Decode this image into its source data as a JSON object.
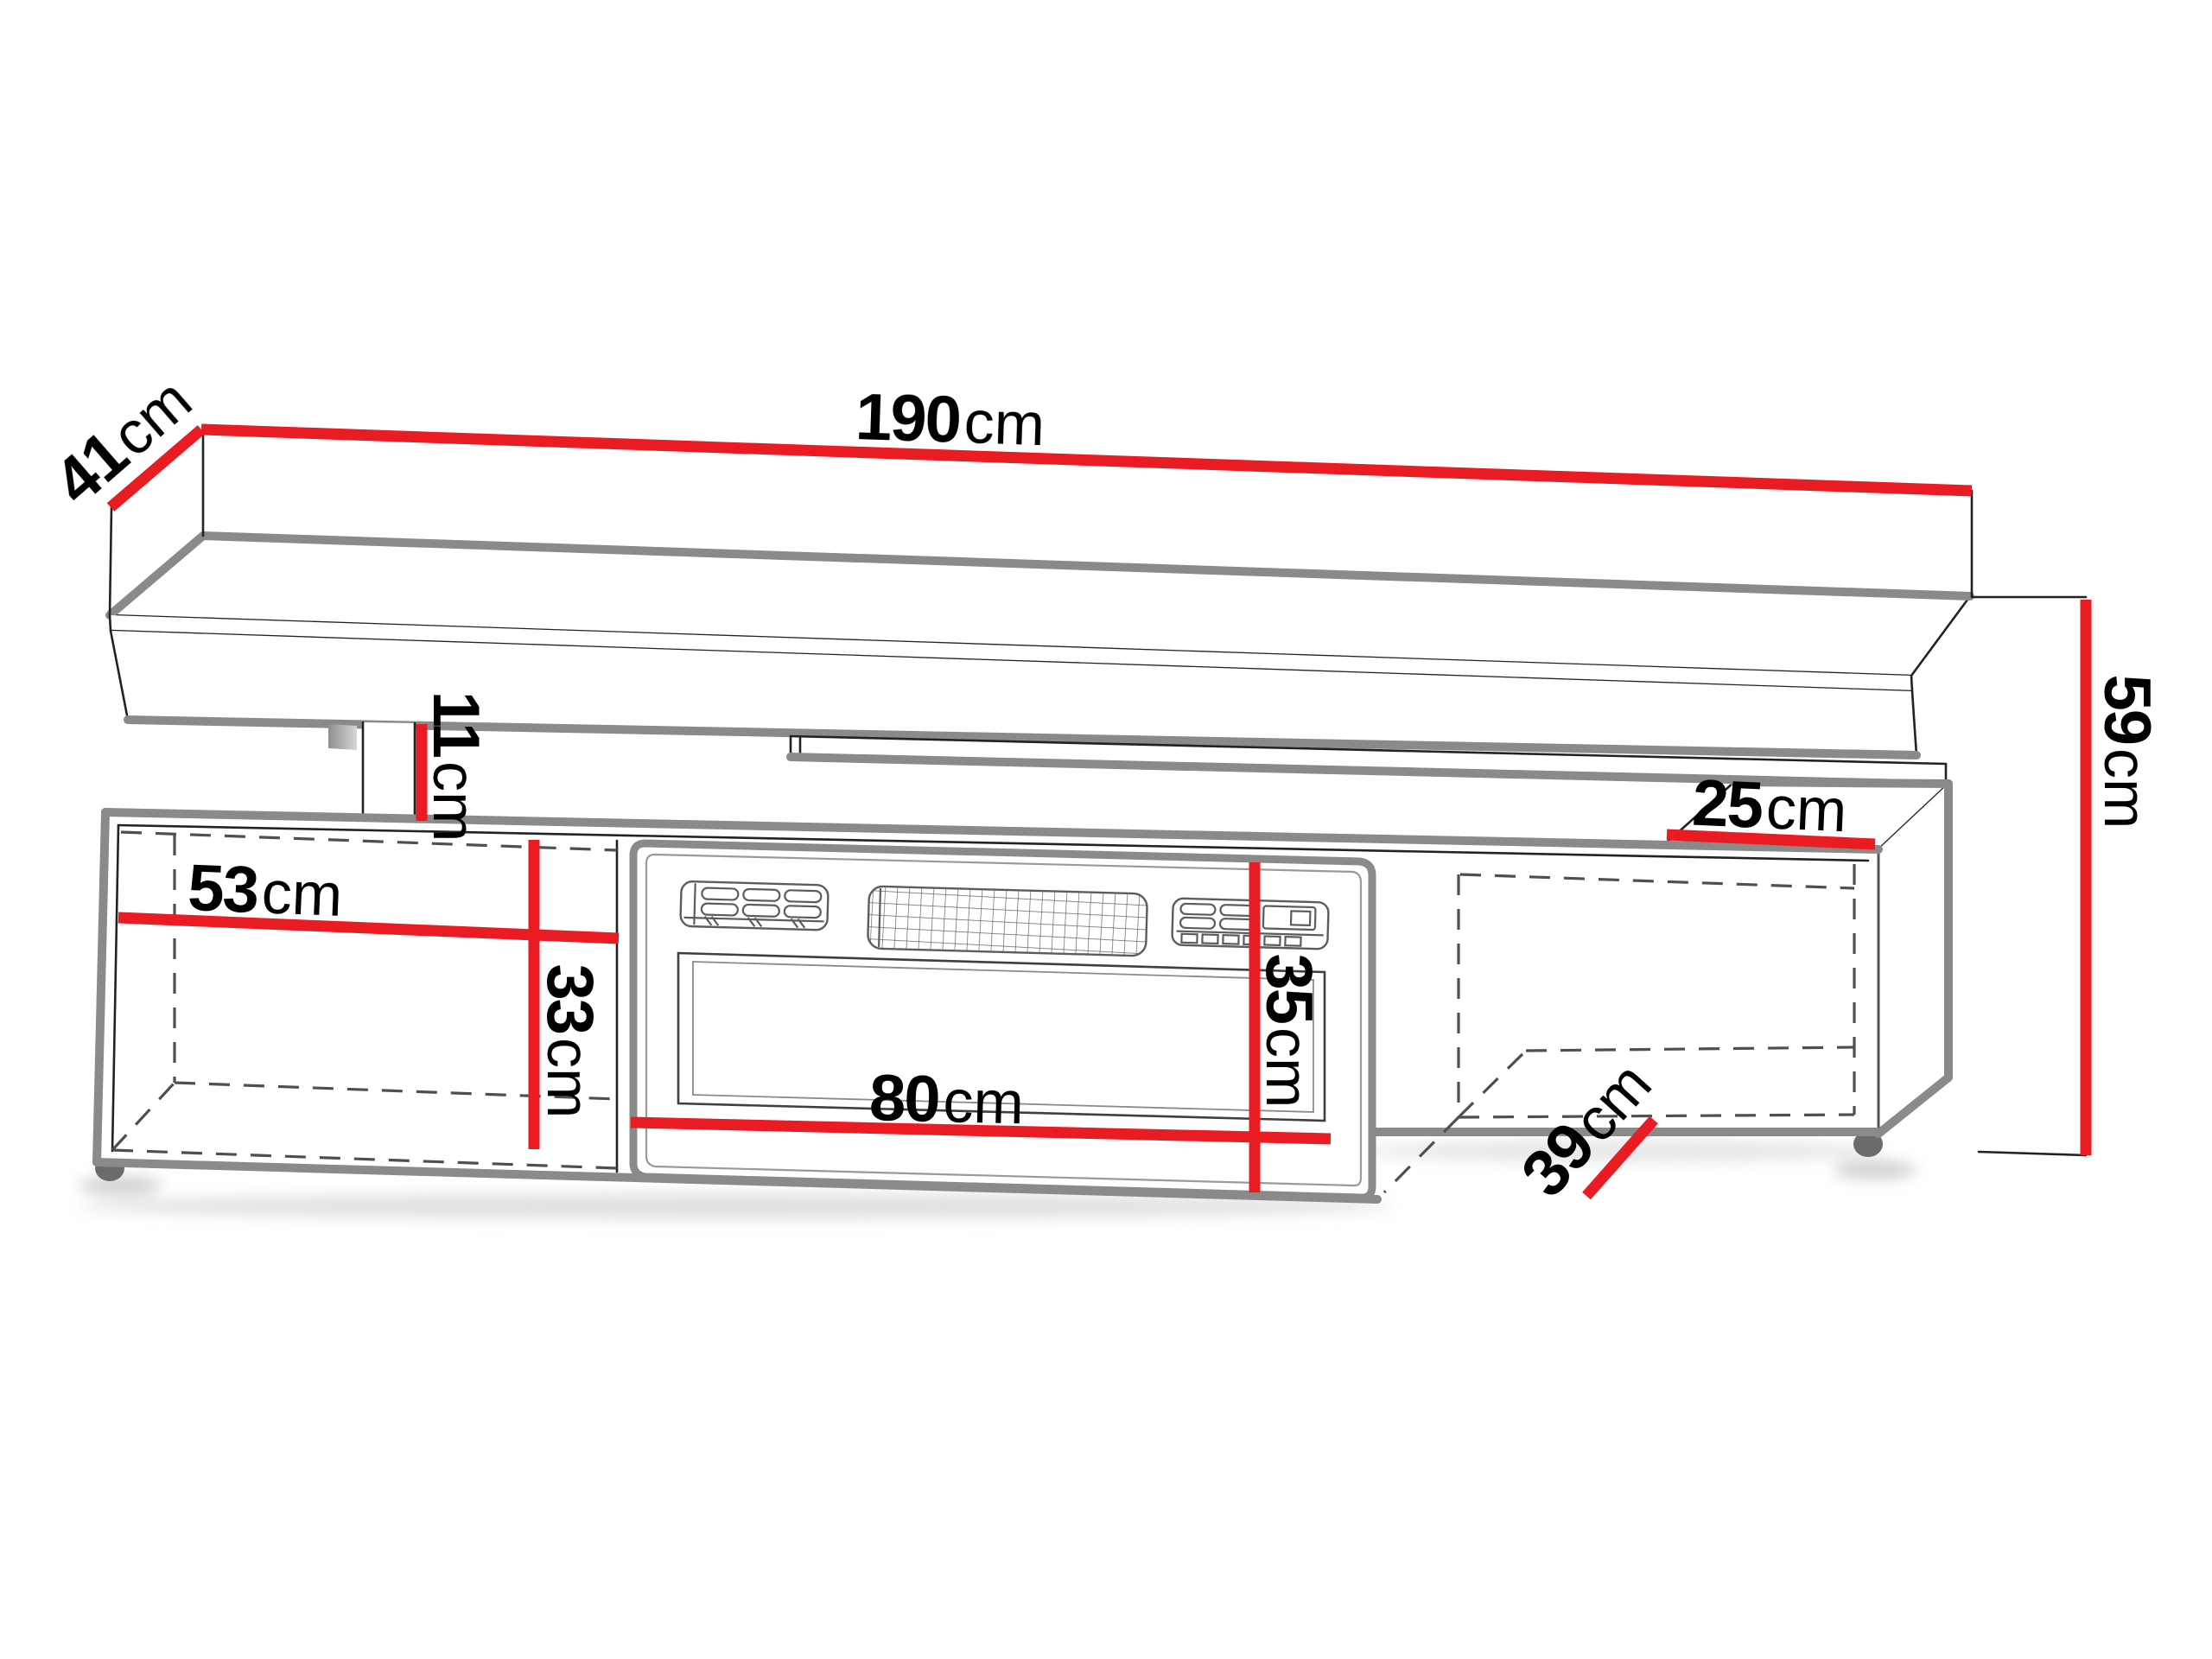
{
  "diagram": {
    "type": "furniture-dimension-drawing",
    "unit": "cm",
    "dimensions": {
      "d190": {
        "value": "190",
        "unit": "cm"
      },
      "d41": {
        "value": "41",
        "unit": "cm"
      },
      "d11": {
        "value": "11",
        "unit": "cm"
      },
      "d53": {
        "value": "53",
        "unit": "cm"
      },
      "d33": {
        "value": "33",
        "unit": "cm"
      },
      "d80": {
        "value": "80",
        "unit": "cm"
      },
      "d35": {
        "value": "35",
        "unit": "cm"
      },
      "d25": {
        "value": "25",
        "unit": "cm"
      },
      "d39": {
        "value": "39",
        "unit": "cm"
      },
      "d59": {
        "value": "59",
        "unit": "cm"
      }
    },
    "colors": {
      "background": "#ffffff",
      "dimension_line": "#ea1c23",
      "outline_thick": "#8a8a8a",
      "outline_thin": "#222222",
      "dashed_line": "#4f4f4f",
      "foot": "#6b6b6b",
      "shadow": "#c9c9c9"
    }
  }
}
